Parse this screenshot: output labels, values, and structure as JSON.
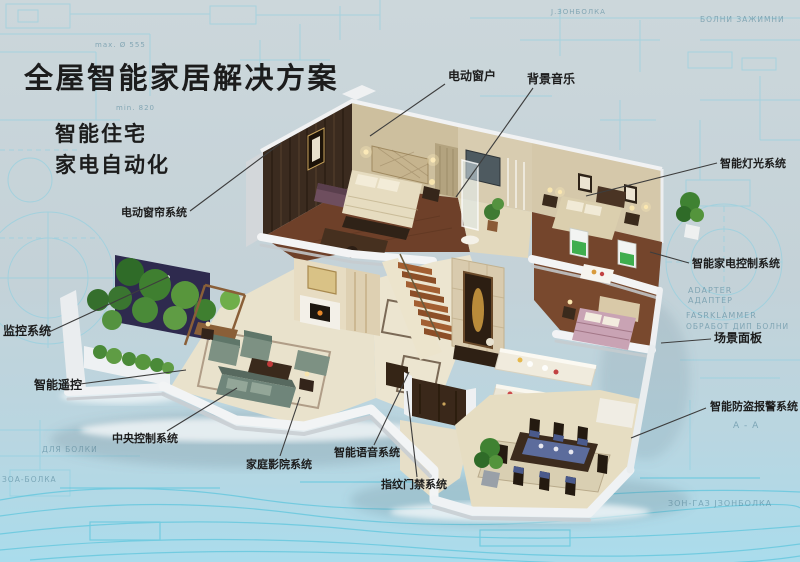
{
  "title": "全屋智能家居解决方案",
  "subtitles": [
    "智能住宅",
    "家电自动化"
  ],
  "colors": {
    "background": "#c7d3d9",
    "background_bottom": "#aeddec",
    "blueprint_line": "#7ecbdf",
    "title_text": "#1c1c1c",
    "label_text": "#1c1c1c",
    "leader_line": "#3d3d3d"
  },
  "labels": [
    {
      "id": "electric-window",
      "text": "电动窗户"
    },
    {
      "id": "background-music",
      "text": "背景音乐"
    },
    {
      "id": "smart-lighting",
      "text": "智能灯光系统"
    },
    {
      "id": "appliance-control",
      "text": "智能家电控制系统"
    },
    {
      "id": "scene-panel",
      "text": "场景面板"
    },
    {
      "id": "burglar-alarm",
      "text": "智能防盗报警系统"
    },
    {
      "id": "electric-curtain",
      "text": "电动窗帘系统"
    },
    {
      "id": "monitoring",
      "text": "监控系统"
    },
    {
      "id": "smart-remote",
      "text": "智能遥控"
    },
    {
      "id": "central-control",
      "text": "中央控制系统"
    },
    {
      "id": "home-theater",
      "text": "家庭影院系统"
    },
    {
      "id": "voice-system",
      "text": "智能语音系统"
    },
    {
      "id": "fingerprint-access",
      "text": "指纹门禁系统"
    }
  ],
  "blueprint_texts": [
    "max. Ø 555",
    "min. 820",
    "Ј.ЗОНБОЛКА",
    "БОЛНИ ЗАЖИМНИ",
    "ADAPTER",
    "АДАПТЕР",
    "FASRKLAMMER",
    "ОБРАБОТ ДИП БОЛНИ",
    "А - А",
    "ДЛЯ БОЛКИ",
    "ЗОА-БОЛКА",
    "ЗОН-ГАЗ ЈЗОНБОЛКА"
  ]
}
